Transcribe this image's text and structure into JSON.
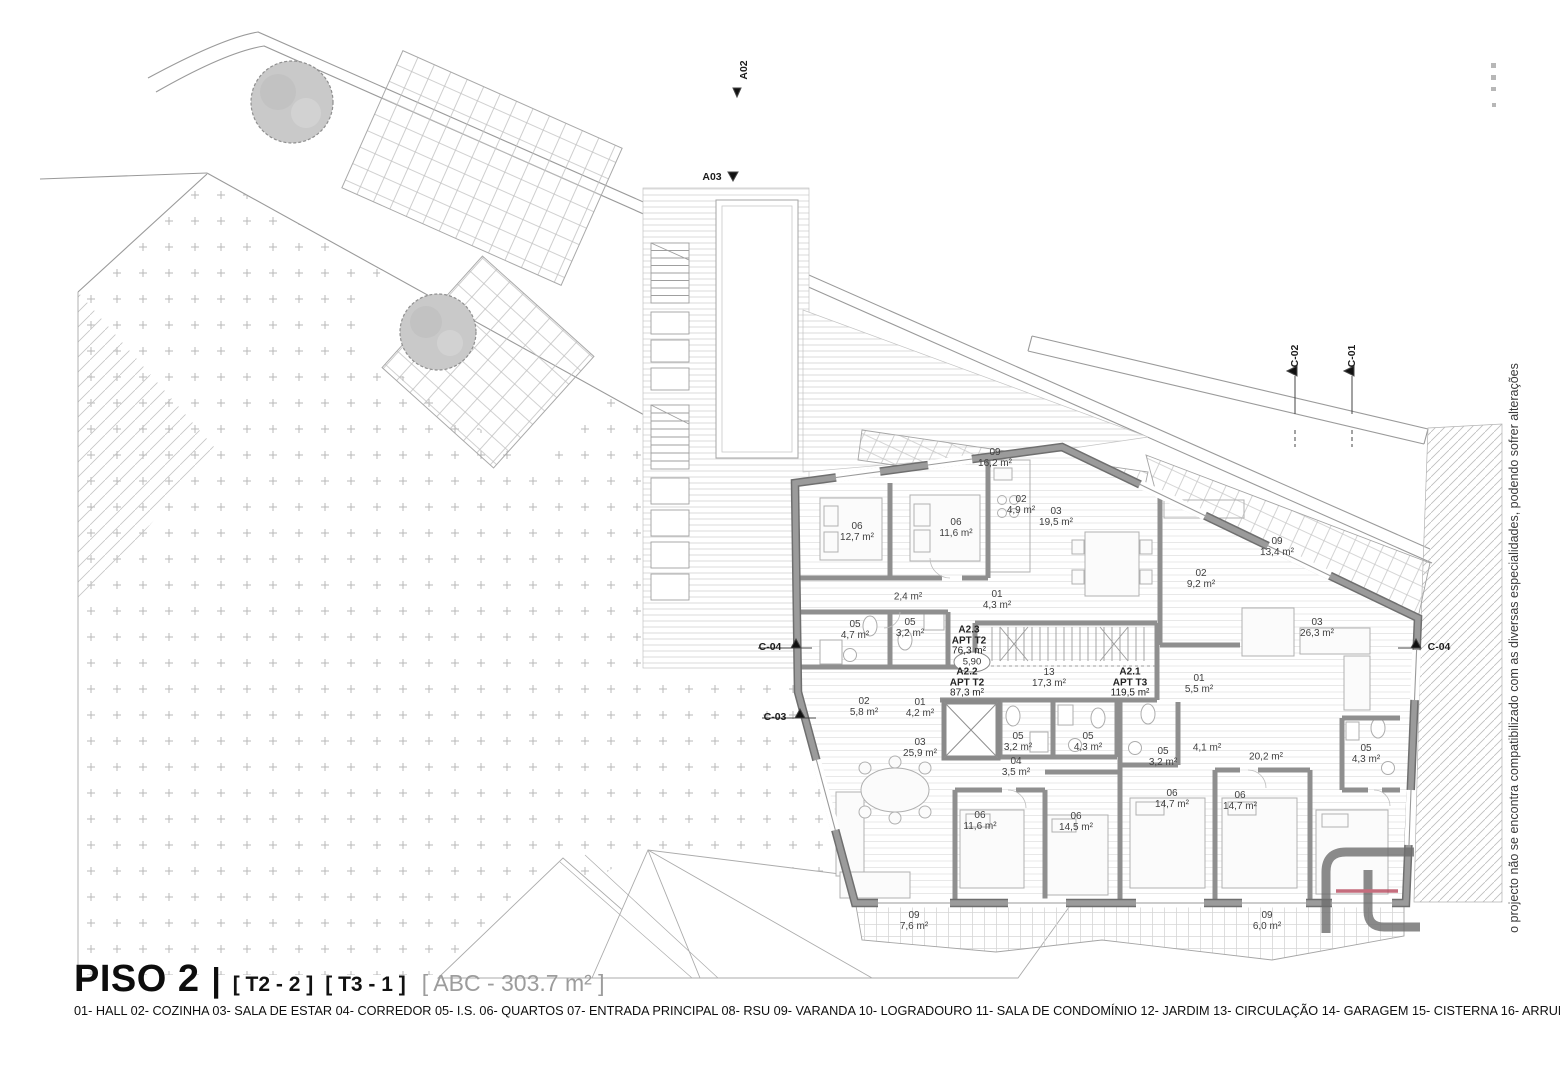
{
  "document": {
    "floor_title": "PISO 2",
    "separator": "|",
    "typologies": [
      "[ T2 - 2 ]",
      "[ T3 - 1 ]"
    ],
    "gross_area": "[ ABC - 303.7 m² ]",
    "legend": "01- HALL 02- COZINHA 03- SALA DE ESTAR 04- CORREDOR 05- I.S. 06- QUARTOS 07- ENTRADA PRINCIPAL 08- RSU 09- VARANDA 10- LOGRADOURO 11- SALA DE CONDOMÍNIO 12- JARDIM 13- CIRCULAÇÃO 14- GARAGEM 15- CISTERNA 16- ARRUMOS",
    "side_note": "o projecto não se encontra compatibilizado com as diversas especialidades, podendo sofrer alterações"
  },
  "level_mark": "5,90",
  "apartments": [
    {
      "code": "A2.3",
      "type": "APT T2",
      "area": "76,3 m²",
      "x": 969,
      "y": 641
    },
    {
      "code": "A2.2",
      "type": "APT T2",
      "area": "87,3 m²",
      "x": 967,
      "y": 683
    },
    {
      "code": "A2.1",
      "type": "APT T3",
      "area": "119,5 m²",
      "x": 1130,
      "y": 683
    }
  ],
  "rooms": [
    {
      "num": "09",
      "area": "16,2 m²",
      "x": 995,
      "y": 458
    },
    {
      "num": "06",
      "area": "12,7 m²",
      "x": 857,
      "y": 532
    },
    {
      "num": "06",
      "area": "11,6 m²",
      "x": 956,
      "y": 528
    },
    {
      "num": "02",
      "area": "4,9 m²",
      "x": 1021,
      "y": 505
    },
    {
      "num": "03",
      "area": "19,5 m²",
      "x": 1056,
      "y": 517
    },
    {
      "num": "",
      "area": "2,4 m²",
      "x": 908,
      "y": 597
    },
    {
      "num": "01",
      "area": "4,3 m²",
      "x": 997,
      "y": 600
    },
    {
      "num": "05",
      "area": "4,7 m²",
      "x": 855,
      "y": 630
    },
    {
      "num": "05",
      "area": "3,2 m²",
      "x": 910,
      "y": 628
    },
    {
      "num": "02",
      "area": "9,2 m²",
      "x": 1201,
      "y": 579
    },
    {
      "num": "09",
      "area": "13,4 m²",
      "x": 1277,
      "y": 547
    },
    {
      "num": "03",
      "area": "26,3 m²",
      "x": 1317,
      "y": 628
    },
    {
      "num": "13",
      "area": "17,3 m²",
      "x": 1049,
      "y": 678
    },
    {
      "num": "01",
      "area": "5,5 m²",
      "x": 1199,
      "y": 684
    },
    {
      "num": "02",
      "area": "5,8 m²",
      "x": 864,
      "y": 707
    },
    {
      "num": "01",
      "area": "4,2 m²",
      "x": 920,
      "y": 708
    },
    {
      "num": "03",
      "area": "25,9 m²",
      "x": 920,
      "y": 748
    },
    {
      "num": "05",
      "area": "3,2 m²",
      "x": 1018,
      "y": 742
    },
    {
      "num": "05",
      "area": "4,3 m²",
      "x": 1088,
      "y": 742
    },
    {
      "num": "04",
      "area": "3,5 m²",
      "x": 1016,
      "y": 767
    },
    {
      "num": "06",
      "area": "11,6 m²",
      "x": 980,
      "y": 821
    },
    {
      "num": "06",
      "area": "14,5 m²",
      "x": 1076,
      "y": 822
    },
    {
      "num": "05",
      "area": "3,2 m²",
      "x": 1163,
      "y": 757
    },
    {
      "num": "",
      "area": "4,1 m²",
      "x": 1207,
      "y": 748
    },
    {
      "num": "",
      "area": "20,2 m²",
      "x": 1266,
      "y": 757
    },
    {
      "num": "05",
      "area": "4,3 m²",
      "x": 1366,
      "y": 754
    },
    {
      "num": "06",
      "area": "14,7 m²",
      "x": 1172,
      "y": 799
    },
    {
      "num": "06",
      "area": "14,7 m²",
      "x": 1240,
      "y": 801
    },
    {
      "num": "09",
      "area": "6,0 m²",
      "x": 1267,
      "y": 921
    },
    {
      "num": "09",
      "area": "7,6 m²",
      "x": 914,
      "y": 921
    }
  ],
  "section_markers": [
    {
      "label": "A02",
      "x": 744,
      "y": 70,
      "rotated": true
    },
    {
      "label": "A03",
      "x": 712,
      "y": 177,
      "rotated": false
    },
    {
      "label": "C-02",
      "x": 1295,
      "y": 356,
      "rotated": true
    },
    {
      "label": "C-01",
      "x": 1352,
      "y": 356,
      "rotated": true
    },
    {
      "label": "C-04",
      "x": 770,
      "y": 647,
      "rotated": false
    },
    {
      "label": "C-03",
      "x": 775,
      "y": 717,
      "rotated": false
    },
    {
      "label": "C-04",
      "x": 1439,
      "y": 647,
      "rotated": false
    }
  ],
  "colors": {
    "wall": "#8c8c8c",
    "red_accent": "#b84a5e",
    "tree_fill": "#c9c9c9"
  }
}
